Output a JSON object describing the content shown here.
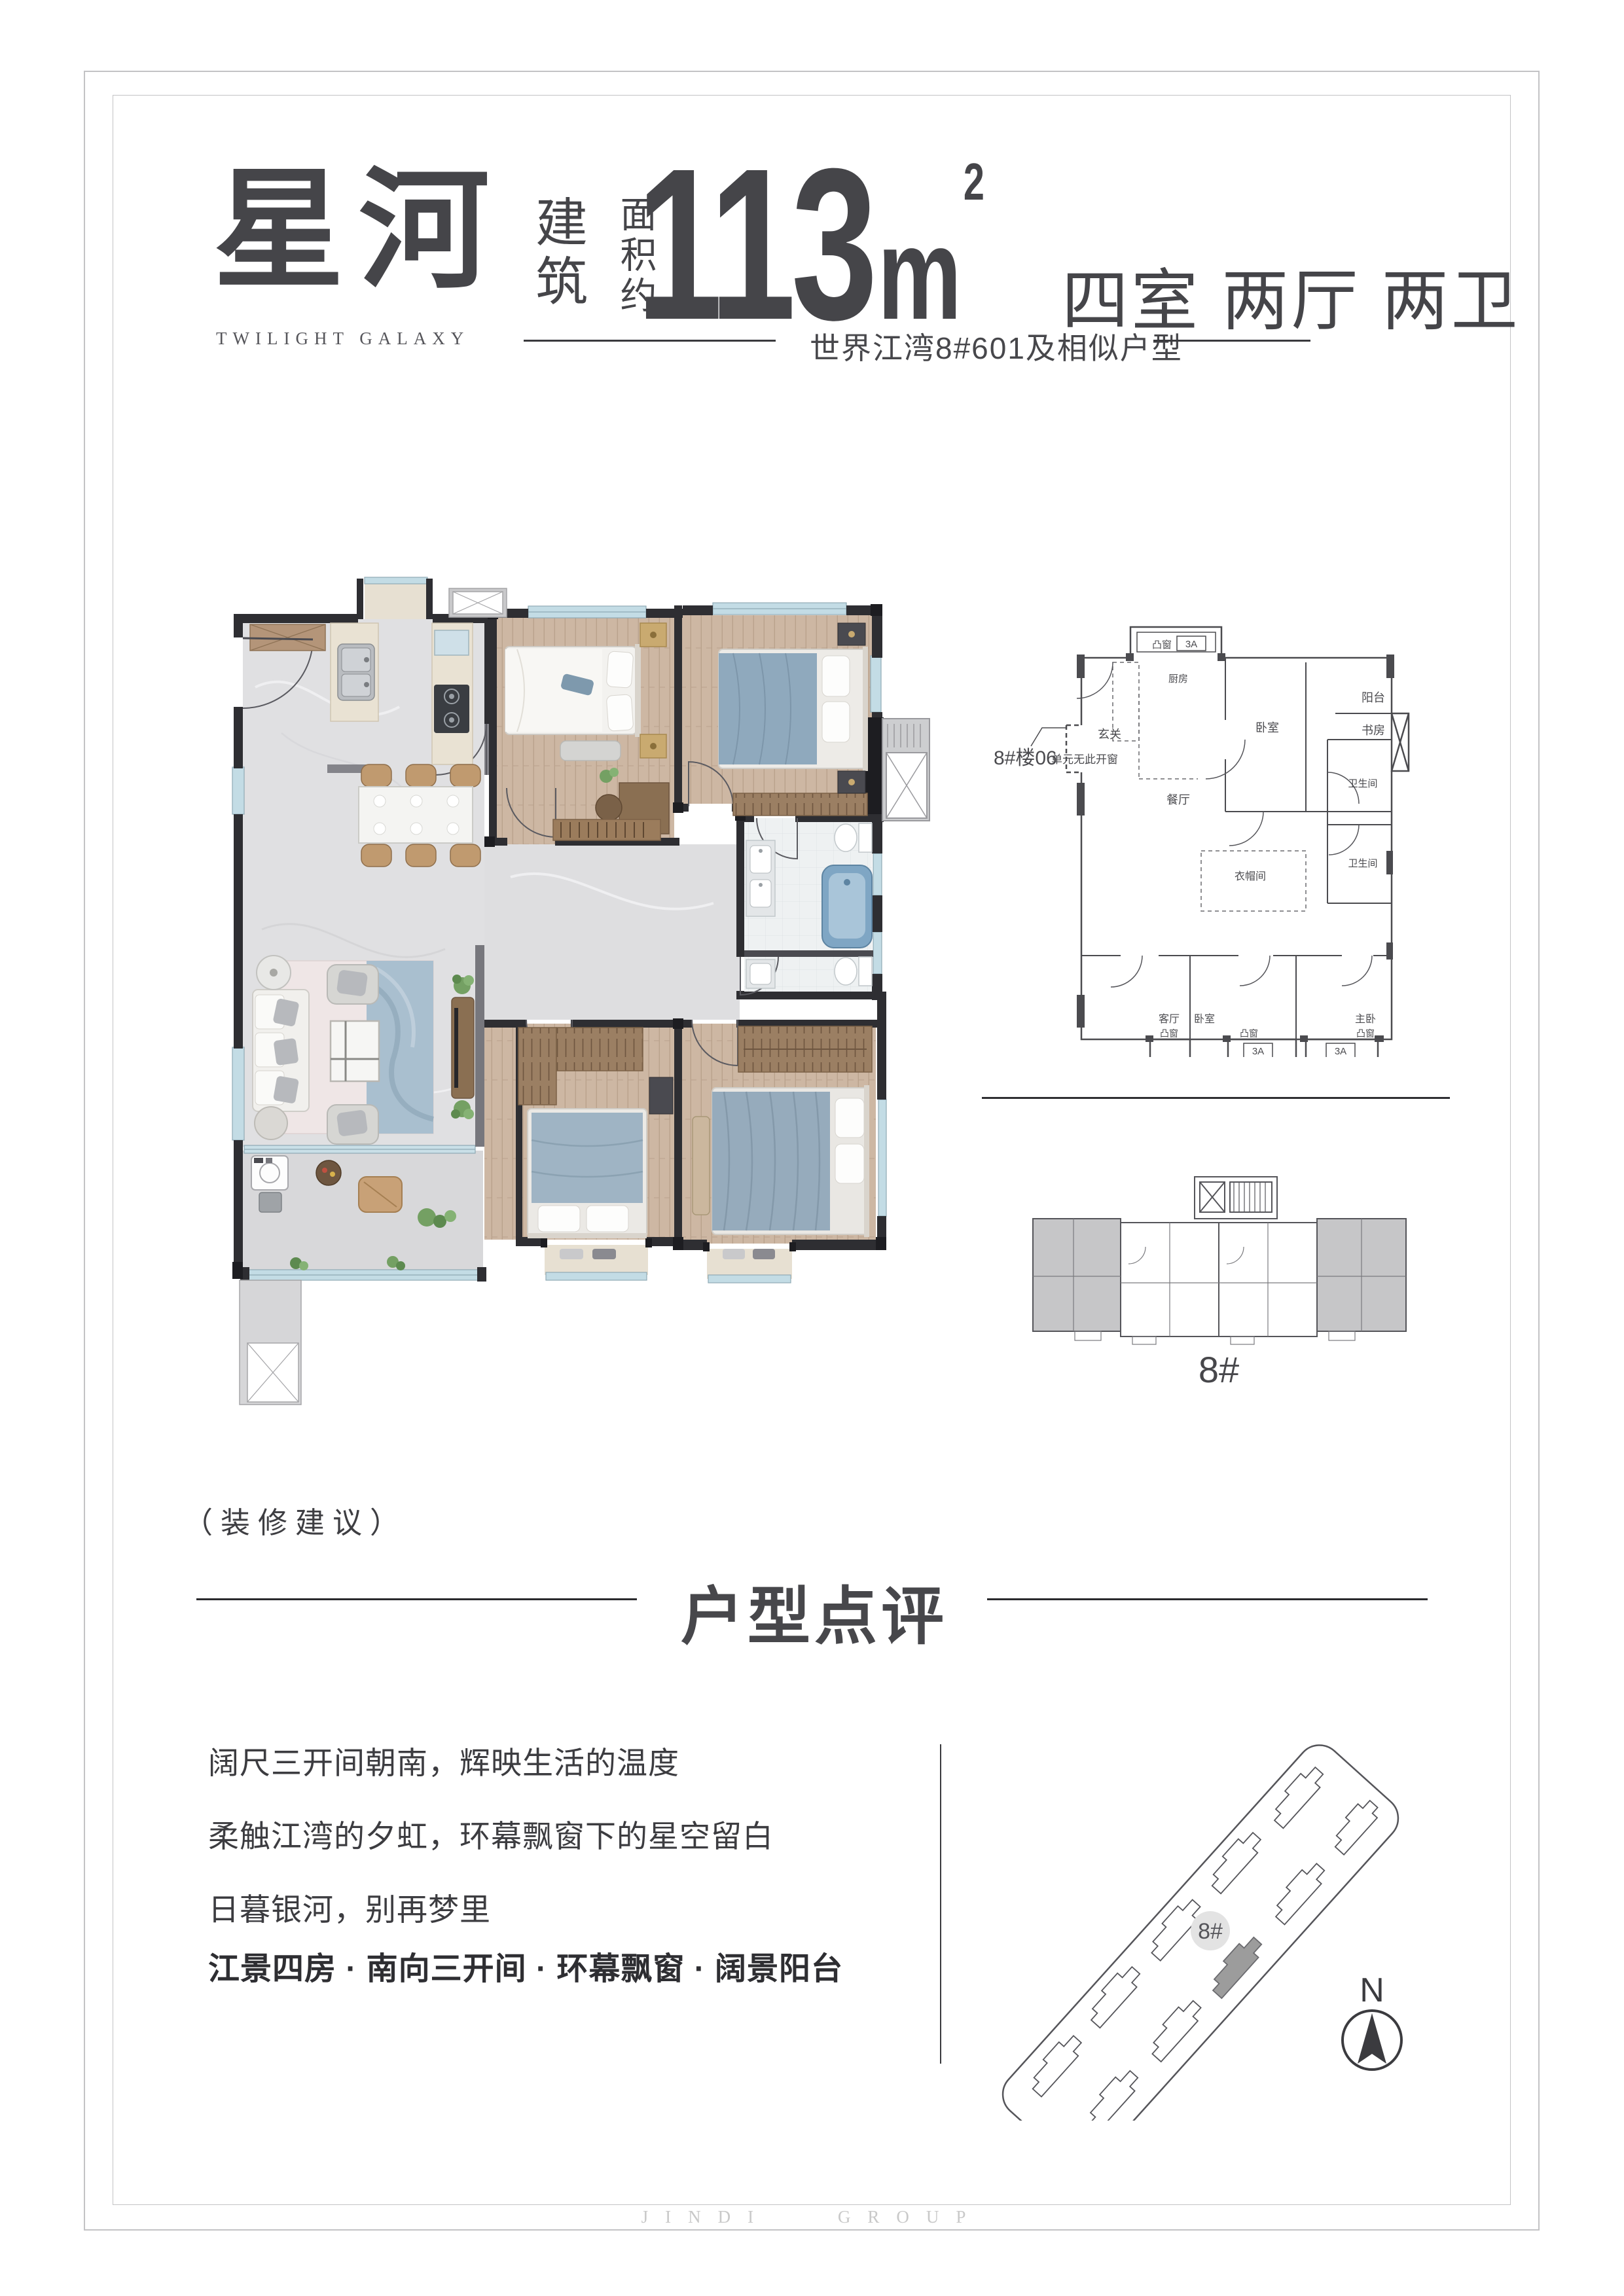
{
  "page": {
    "watermark": "JINDI GROUP"
  },
  "header": {
    "title_cn": "星河",
    "title_en": "TWILIGHT GALAXY",
    "area_label_top": "建筑",
    "area_label_bottom": "面积约",
    "area_value": "113",
    "area_unit": "m",
    "area_exponent": "2",
    "rooms": "四室 两厅 两卫",
    "subtitle": "世界江湾8#601及相似户型"
  },
  "cad_plan": {
    "callout_code": "8#楼06",
    "callout_note": "单元无此开窗",
    "labels": {
      "kitchen": "厨房",
      "entry": "玄关",
      "dining": "餐厅",
      "bedroom2": "卧室",
      "study": "书房",
      "balcony": "阳台",
      "bath1": "卫生间",
      "bath2": "卫生间",
      "cloak": "衣帽间",
      "living": "客厅",
      "bedroom4": "卧室",
      "master": "主卧",
      "bay_window": "凸窗",
      "ac_code": "3A"
    }
  },
  "key_plan": {
    "building_label": "8#"
  },
  "site_plan": {
    "building_badge": "8#",
    "compass_label": "N"
  },
  "notes": {
    "decor_note": "（装修建议）"
  },
  "review": {
    "heading": "户型点评",
    "line1": "阔尺三开间朝南，辉映生活的温度",
    "line2": "柔触江湾的夕虹，环幕飘窗下的星空留白",
    "line3": "日暮银河，别再梦里",
    "highlight": "江景四房 · 南向三开间 · 环幕飘窗 · 阔景阳台"
  }
}
